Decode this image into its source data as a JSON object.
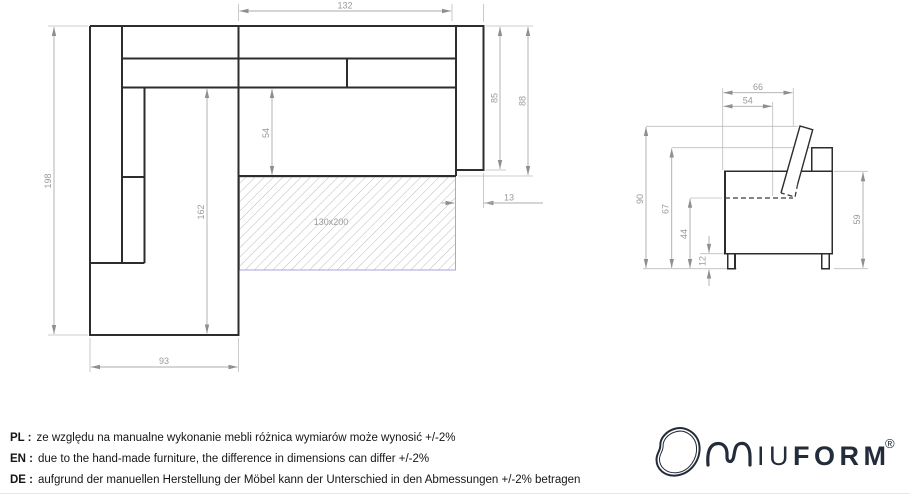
{
  "top_view": {
    "dims": {
      "length_total": "198",
      "length_inner": "162",
      "chaise_width": "93",
      "seat_width": "132",
      "seat_depth": "54",
      "side_depth": "85",
      "side_depth_outer": "88",
      "armrest_width": "13",
      "sleeping_area": "130x200"
    }
  },
  "side_view": {
    "dims": {
      "depth_with_backrest": "66",
      "seat_depth": "54",
      "height_total": "90",
      "height_backrest": "67",
      "height_seat_line": "44",
      "leg_height": "12",
      "armrest_height": "59"
    }
  },
  "notes": [
    {
      "prefix": "PL :",
      "text": "ze względu na manualne wykonanie mebli różnica wymiarów może wynosić +/-2%"
    },
    {
      "prefix": "EN :",
      "text": "due to the hand-made furniture, the difference in dimensions can differ +/-2%"
    },
    {
      "prefix": "DE :",
      "text": "aufgrund der manuellen Herstellung der Möbel kann der Unterschied in den Abmessungen +/-2% betragen"
    }
  ],
  "logo": {
    "m": "M",
    "iu": "IU",
    "form": "FORM",
    "registered": "®"
  },
  "colors": {
    "drawing_line": "#2d2d2d",
    "dimension_line": "#ababab",
    "dimension_text": "#9a9a9a",
    "mattress_border": "#a9a6d4",
    "logo_ink": "#232c3a"
  }
}
